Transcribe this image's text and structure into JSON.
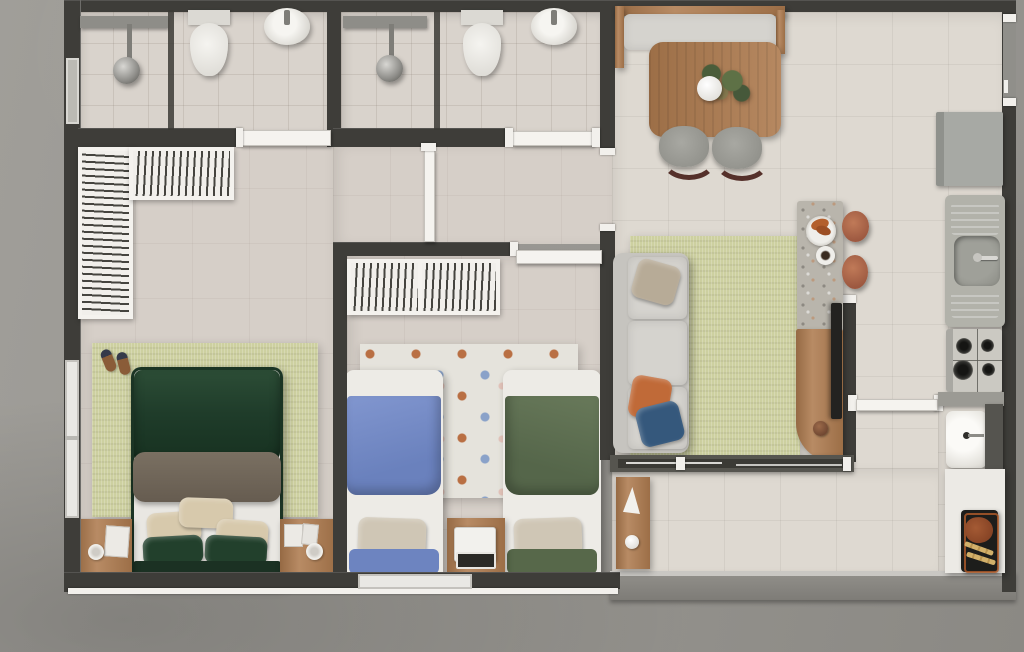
{
  "meta": {
    "title": "Apartment floor plan – top-down 3D render",
    "description": "Two-bedroom apartment plan with two bathrooms, living/dining room, kitchen, balcony and grill area. No visible text in image.",
    "canvas": {
      "width": 1024,
      "height": 652
    }
  },
  "palette": {
    "wall": "#3e3d39",
    "concrete": "#a09e99",
    "concrete-dark": "#8b8984",
    "tile-bath": "#d9d3cc",
    "floor-bedroom": "#d6cfc8",
    "floor-living": "#ded9d1",
    "rug-green": "#cdd0a0",
    "rug-dots": "#e5e3dc",
    "wood": "#ae7b4f",
    "wood-dark": "#8c6039",
    "white-fixture": "#f0efeb",
    "sofa-gray": "#d5d3ce",
    "chair-gray": "#9b9b95",
    "green-dark": "#1f3a29",
    "taupe": "#6f6558",
    "beige": "#d7c9ac",
    "blue-blanket": "#7389c5",
    "olive-blanket": "#5d6d4f",
    "navy-pillow": "#35587c",
    "orange-pillow": "#c06a38",
    "terrazzo": "#b9b5ac",
    "terracotta": "#b0684a",
    "steel": "#a9aba6",
    "glass": "#3b3a35",
    "grill-black": "#1d1d1b",
    "meat": "#8a4527",
    "skewer": "#d2b06a"
  },
  "rooms": [
    {
      "id": "bathroom-1",
      "name": "Bathroom 1",
      "items": [
        "walk-in shower",
        "glass partition",
        "toilet",
        "round washbasin",
        "window"
      ]
    },
    {
      "id": "bathroom-2",
      "name": "Bathroom 2",
      "items": [
        "walk-in shower",
        "glass partition",
        "toilet",
        "round washbasin"
      ]
    },
    {
      "id": "master-bedroom",
      "name": "Master bedroom",
      "items": [
        "L-shaped open closet with hangers",
        "double bed with dark-green bedding",
        "nightstand left",
        "nightstand right",
        "green area rug",
        "slippers",
        "window"
      ]
    },
    {
      "id": "bedroom-2",
      "name": "Bedroom 2",
      "items": [
        "open wardrobe with hangers",
        "single bed with blue blanket",
        "single bed with green blanket",
        "desk with laptop",
        "polka-dot rug",
        "window"
      ]
    },
    {
      "id": "hallway",
      "name": "Hallway",
      "items": [
        "open doors"
      ]
    },
    {
      "id": "living-dining",
      "name": "Living / dining room",
      "items": [
        "dining bench",
        "wooden dining table with plant",
        "two gray chairs",
        "three-seat sofa with cushions",
        "green area rug",
        "terrazzo breakfast counter",
        "two terracotta stools",
        "curved wooden TV sideboard with TV"
      ]
    },
    {
      "id": "kitchen",
      "name": "Kitchen",
      "items": [
        "refrigerator",
        "sink counter with drainboards and faucet",
        "4-burner gas cooktop",
        "entrance door"
      ]
    },
    {
      "id": "balcony",
      "name": "Balcony",
      "items": [
        "sliding glass door",
        "wooden shelf with sailboat decor",
        "concrete parapet"
      ]
    },
    {
      "id": "service-area",
      "name": "Grill / service area",
      "items": [
        "laundry tank with faucet",
        "white counter",
        "barbecue grill with steak and skewers",
        "service door"
      ]
    }
  ],
  "counts": {
    "bedrooms": 2,
    "bathrooms": 2,
    "single_beds": 2,
    "double_beds": 1,
    "stools": 2,
    "dining_chairs": 2,
    "stove_burners": 4
  }
}
